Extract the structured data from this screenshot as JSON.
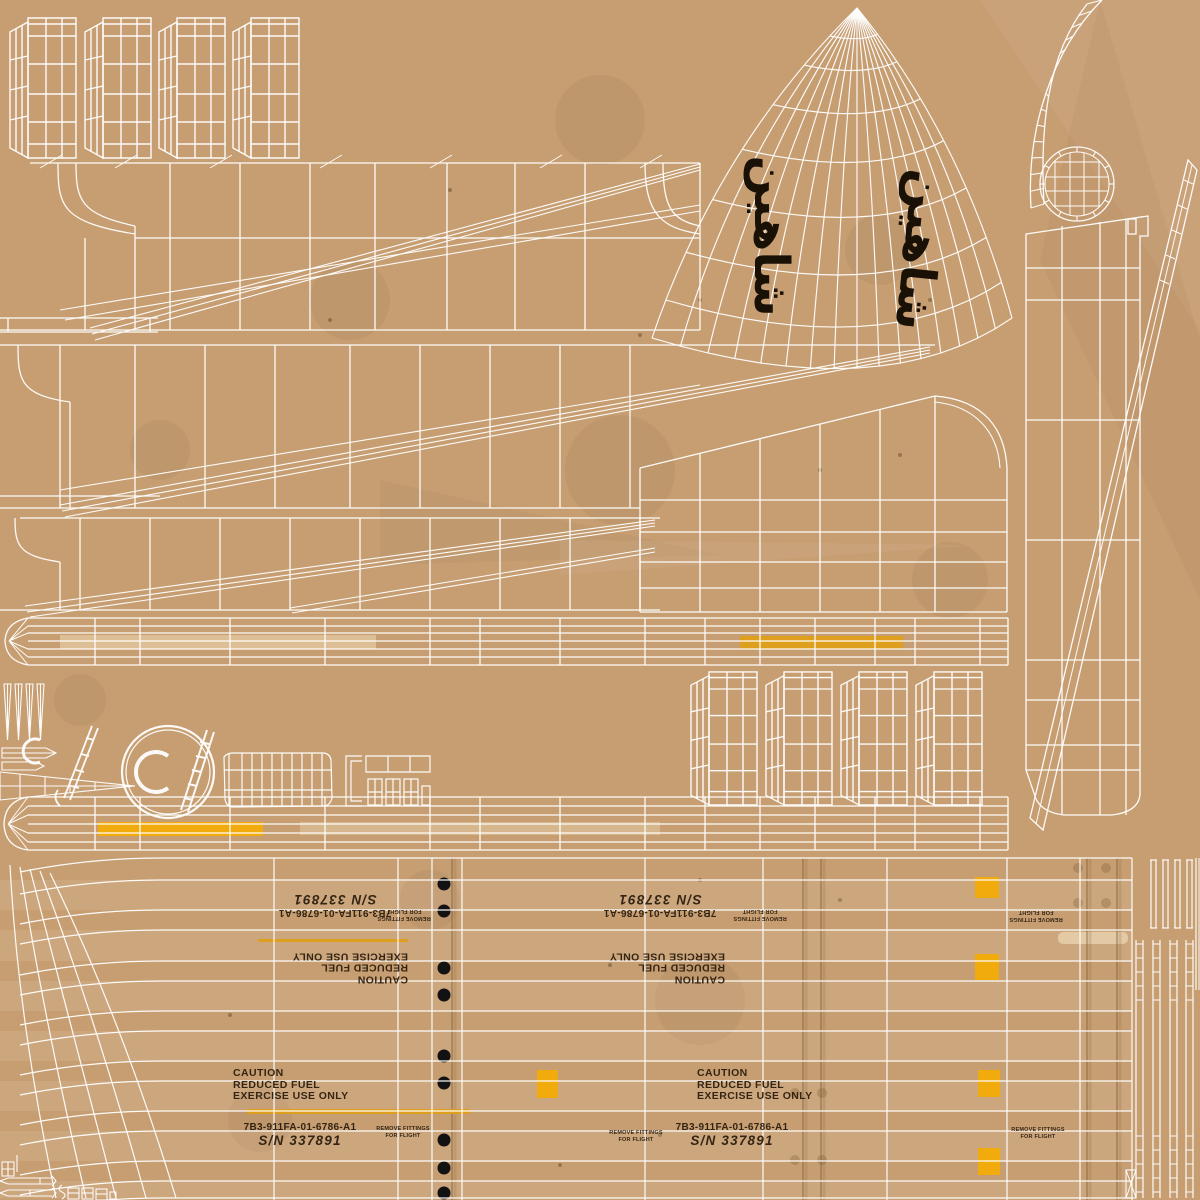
{
  "atlas": {
    "description_label": "missile-texture-atlas"
  },
  "nose": {
    "brand_label": "شاهین"
  },
  "stencils": {
    "caution_lines": [
      "CAUTION",
      "REDUCED FUEL",
      "EXERCISE USE ONLY"
    ],
    "part_number": "7B3-911FA-01-6786-A1",
    "serial_number": "S/N 337891",
    "remove_fittings_lines": [
      "REMOVE FITTINGS",
      "FOR FLIGHT"
    ]
  },
  "colors": {
    "background": "#c79e72",
    "wireframe": "#ffffff",
    "ink": "#241708",
    "amber_stripe": "#de9f1e",
    "yellow_marker": "#f2ab0c",
    "pale_stripe": "#e8d2ae",
    "rivet_dot": "#121212",
    "seam": "#7c5c38"
  }
}
